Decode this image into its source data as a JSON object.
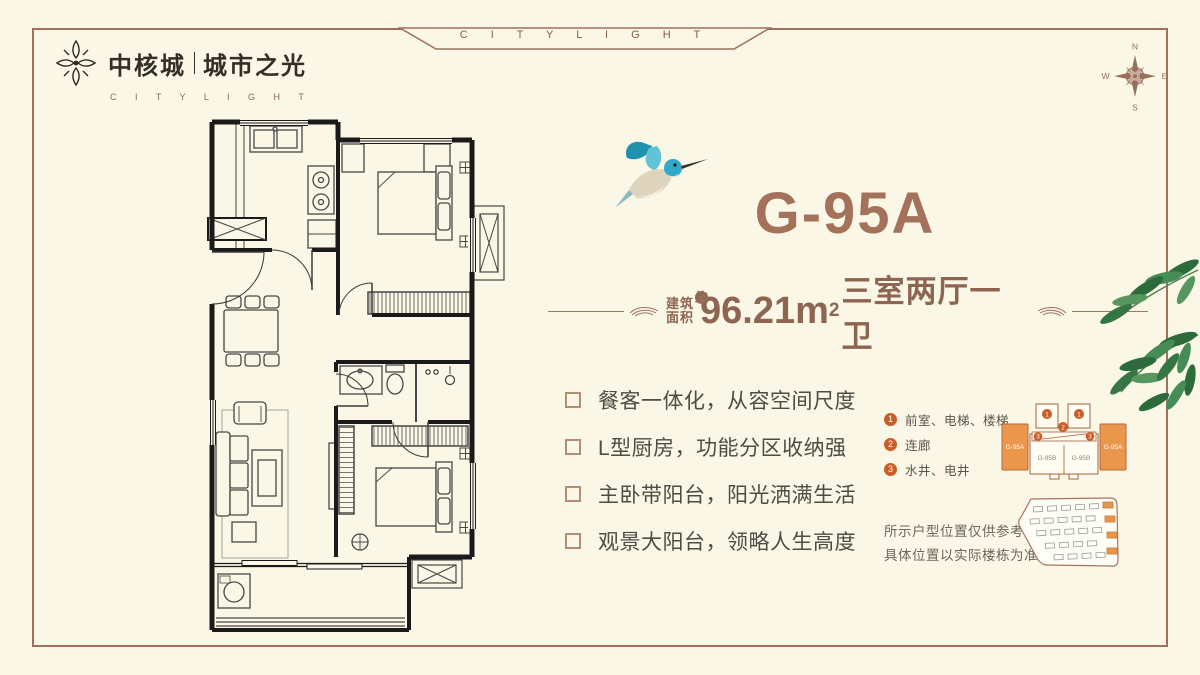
{
  "page": {
    "background": "#faf7e6",
    "frame_color": "#a0705c"
  },
  "brand": {
    "name": "中核城",
    "subname": "城市之光",
    "latin": "C I T Y L I G H T"
  },
  "banner": {
    "text": "C I T Y L I G H T"
  },
  "compass": {
    "north": "N",
    "south": "S",
    "east": "E",
    "west": "W"
  },
  "unit": {
    "title": "G-95A",
    "area_label_line1": "建筑",
    "area_label_line2": "面积",
    "area_approx": "约",
    "area_value": "96.21m",
    "area_exponent": "2",
    "layout": "三室两厅一卫"
  },
  "features": [
    "餐客一体化，从容空间尺度",
    "L型厨房，功能分区收纳强",
    "主卧带阳台，阳光洒满生活",
    "观景大阳台，领略人生高度"
  ],
  "legend": {
    "items": [
      {
        "num": "1",
        "label": "前室、电梯、楼梯"
      },
      {
        "num": "2",
        "label": "连廊"
      },
      {
        "num": "3",
        "label": "水井、电井"
      }
    ]
  },
  "diagram": {
    "left_block": "G-95A",
    "right_block": "G-95A",
    "center_left": "G-95B",
    "center_right": "G-95B",
    "marker_1a": "1",
    "marker_1b": "1",
    "marker_2": "2",
    "marker_3a": "3",
    "marker_3b": "3"
  },
  "disclaimer": {
    "line1": "所示户型位置仅供参考",
    "line2": "具体位置以实际楼栋为准"
  },
  "colors": {
    "accent_brown": "#a5735c",
    "text_brown": "#8d6550",
    "orange_block": "#ea964d",
    "legend_orange": "#cb5d28",
    "leaf_green": "#3f7d4e",
    "bird_teal": "#2fa9c8"
  }
}
